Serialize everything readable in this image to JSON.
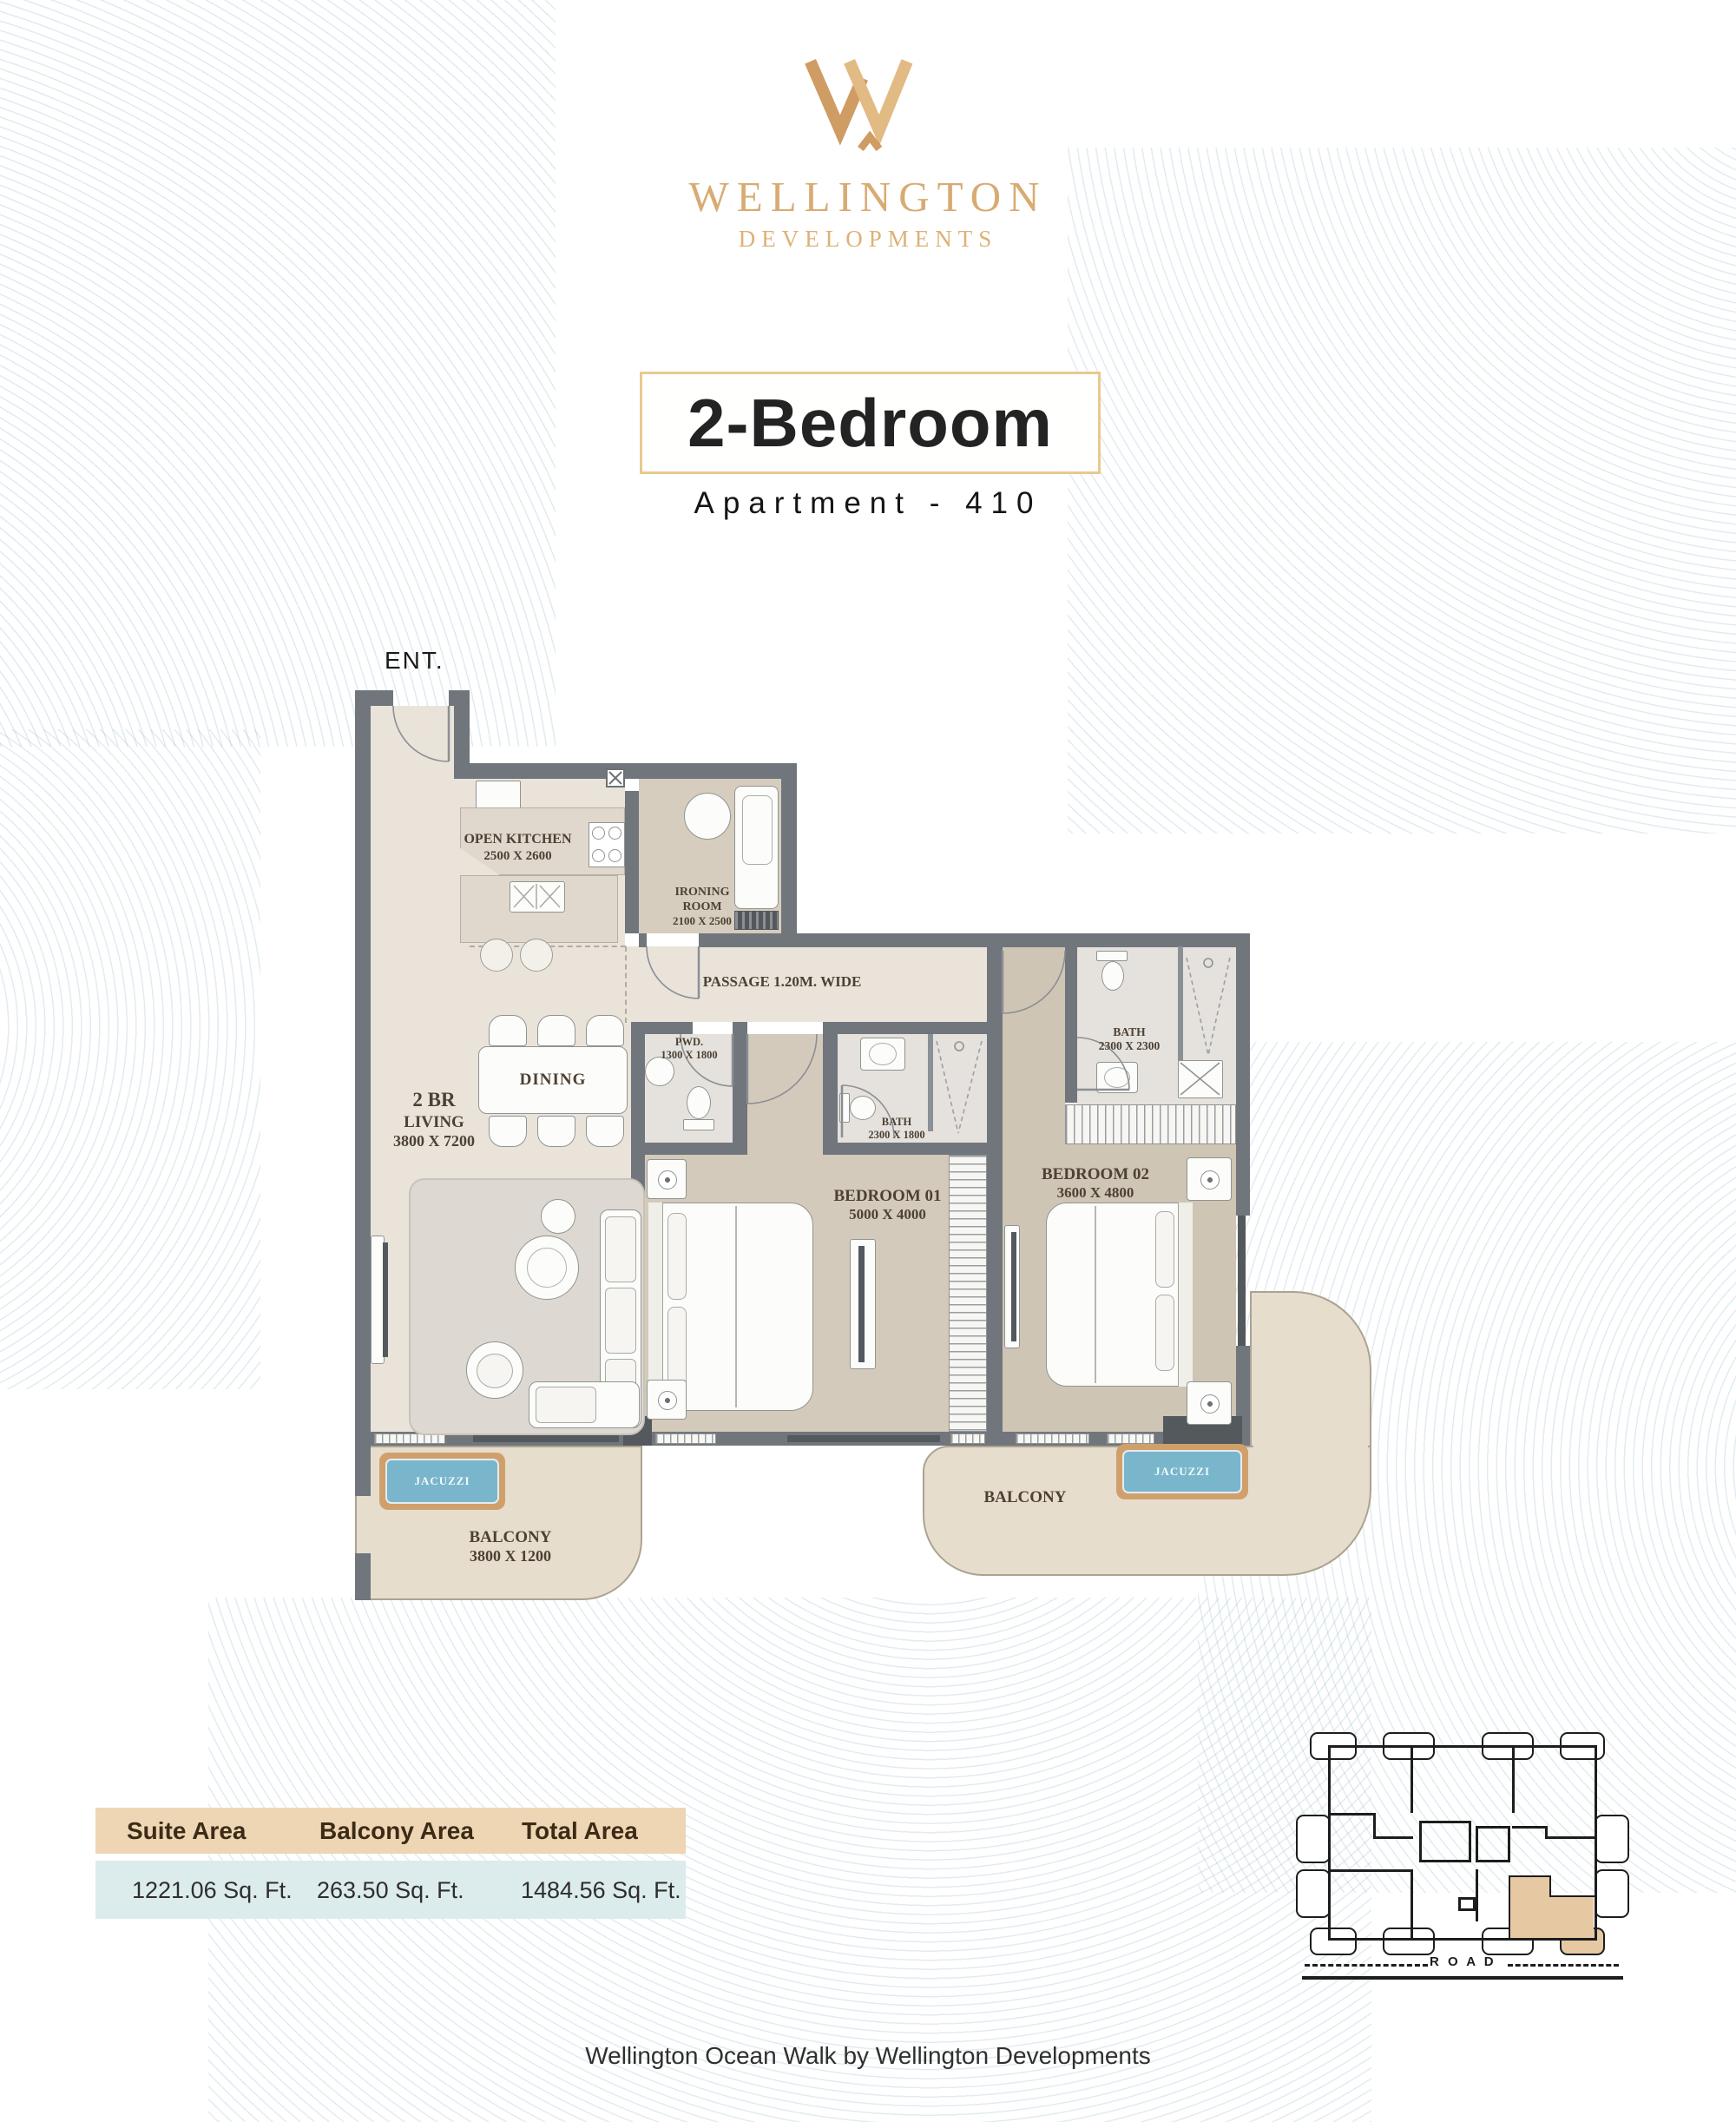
{
  "brand": {
    "name": "WELLINGTON",
    "division": "DEVELOPMENTS"
  },
  "header": {
    "unit_type": "2-Bedroom",
    "apartment": "Apartment - 410"
  },
  "plan": {
    "entrance": "ENT.",
    "open_kitchen": {
      "name": "OPEN KITCHEN",
      "dims": "2500 X 2600"
    },
    "ironing_room": {
      "name_line1": "IRONING",
      "name_line2": "ROOM",
      "dims": "2100 X 2500"
    },
    "passage": {
      "name": "PASSAGE 1.20M. WIDE"
    },
    "pwd": {
      "name": "PWD.",
      "dims": "1300 X 1800"
    },
    "dining": {
      "name": "DINING"
    },
    "living": {
      "name_line1": "2 BR",
      "name_line2": "LIVING",
      "dims": "3800 X 7200"
    },
    "bath_1": {
      "name": "BATH",
      "dims": "2300 X 1800"
    },
    "bath_2": {
      "name": "BATH",
      "dims": "2300 X 2300"
    },
    "bedroom_1": {
      "name": "BEDROOM 01",
      "dims": "5000 X 4000"
    },
    "bedroom_2": {
      "name": "BEDROOM 02",
      "dims": "3600 X 4800"
    },
    "balcony_left": {
      "name": "BALCONY",
      "dims": "3800 X 1200"
    },
    "balcony_right": {
      "name": "BALCONY"
    },
    "jacuzzi_left": {
      "name": "JACUZZI"
    },
    "jacuzzi_right": {
      "name": "JACUZZI"
    }
  },
  "area_table": {
    "headers": [
      "Suite Area",
      "Balcony Area",
      "Total Area"
    ],
    "values": [
      "1221.06 Sq. Ft.",
      "263.50 Sq. Ft.",
      "1484.56 Sq. Ft."
    ]
  },
  "key_plan": {
    "road": "R O A D"
  },
  "footer": "Wellington Ocean Walk by Wellington Developments",
  "colors": {
    "gold": "#d8ab72",
    "wall": "#70767c",
    "balcony_fill": "#e7ddcd",
    "jacuzzi_water": "#79b6cc",
    "table_header_bg": "#eed6b4",
    "table_value_bg": "#dcebec",
    "highlighted_unit": "#e6c9a2"
  }
}
